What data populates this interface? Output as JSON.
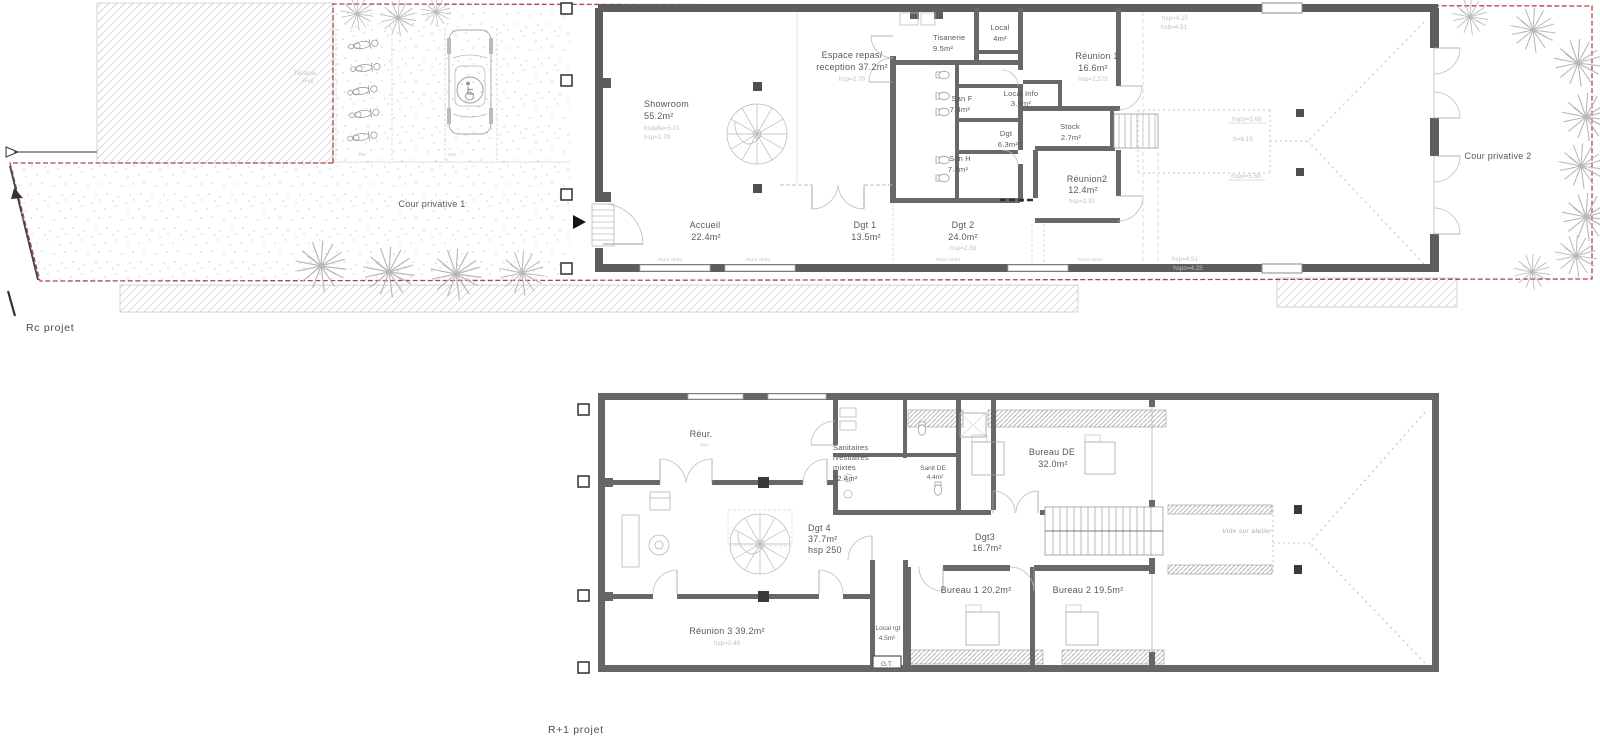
{
  "colors": {
    "wall": "#5d5d5d",
    "inner_wall": "#686868",
    "boundary_red": "#b34040",
    "label_text": "#585858",
    "faint_annotation": "#c2c2c2"
  },
  "rc": {
    "title": "Rc projet",
    "cour1": "Cour privative 1",
    "cour2": "Cour privative 2",
    "terrasse1": "Terrasse",
    "terrasse2": "R+1",
    "dim250": "250",
    "dim330": "330",
    "dim620": "6.20",
    "showroom_name": "Showroom",
    "showroom_area": "55.2m²",
    "showroom_sub1": "hsdalle=5.01",
    "showroom_sub2": "hsp=2.79",
    "espace_l1": "Espace repas/",
    "espace_l2": "reception 37.2m²",
    "espace_sub": "hsp=2.79",
    "tisanerie_name": "Tisanerie",
    "tisanerie_area": "9.5m²",
    "local_name": "Local",
    "local_area": "4m²",
    "reunion1_name": "Réunion 1",
    "reunion1_area": "16.6m²",
    "reunion1_sub": "hsp=2.375",
    "localinfo_name": "Local Info",
    "localinfo_area": "3.3m²",
    "sanf_name": "San F",
    "sanf_area": "7.4m²",
    "dgt_name": "Dgt",
    "dgt_area": "6.3m²",
    "sanh_name": "San H",
    "sanh_area": "7.4m²",
    "stock_name": "Stock",
    "stock_area": "2.7m²",
    "reunion2_name": "Réunion2",
    "reunion2_area": "12.4m²",
    "reunion2_sub": "hsp=2.31",
    "accueil_name": "Accueil",
    "accueil_area": "22.4m²",
    "dgt1_name": "Dgt 1",
    "dgt1_area": "13.5m²",
    "dgt2_name": "Dgt 2",
    "dgt2_area": "24.0m²",
    "dgt2_sub": "hsp=2.38",
    "at_top1": "hsp=4.25",
    "at_top2": "hsb=4.51",
    "at_mid1": "hspo=5.68",
    "at_mid2": "h=6.19",
    "at_mid3": "hspo=5.68",
    "at_bot1": "hsp=4.51",
    "at_bot2": "hspo=4.25",
    "facade1": "Paroi vitrée",
    "facade2": "Paroi vitrée",
    "facade3": "Paroi vitrée",
    "facade4": "Paroi vitrée"
  },
  "r1": {
    "title": "R+1 projet",
    "reur_name": "Réur.",
    "reur_sub": "hsp=",
    "sanit_l1": "Sanitaires",
    "sanit_l2": "/vestiaires",
    "sanit_l3": "mixtes",
    "sanit_l4": "12.4m²",
    "sanitde_name": "Sanit DE",
    "sanitde_area": "4.4m²",
    "bureaude_name": "Bureau DE",
    "bureaude_area": "32.0m²",
    "dgt4_name": "Dgt 4",
    "dgt4_area": "37.7m²",
    "dgt4_sub": "hsp 250",
    "dgt3_name": "Dgt3",
    "dgt3_area": "16.7m²",
    "vide": "Vide sur atelier",
    "bureau1": "Bureau 1 20.2m²",
    "bureau2": "Bureau 2 19.5m²",
    "reunion3": "Réunion 3 39.2m²",
    "reunion3_sub": "hsp=2.48",
    "localrgt_name": "Local rgt",
    "localrgt_area": "4.5m²",
    "gt": "G.T."
  }
}
